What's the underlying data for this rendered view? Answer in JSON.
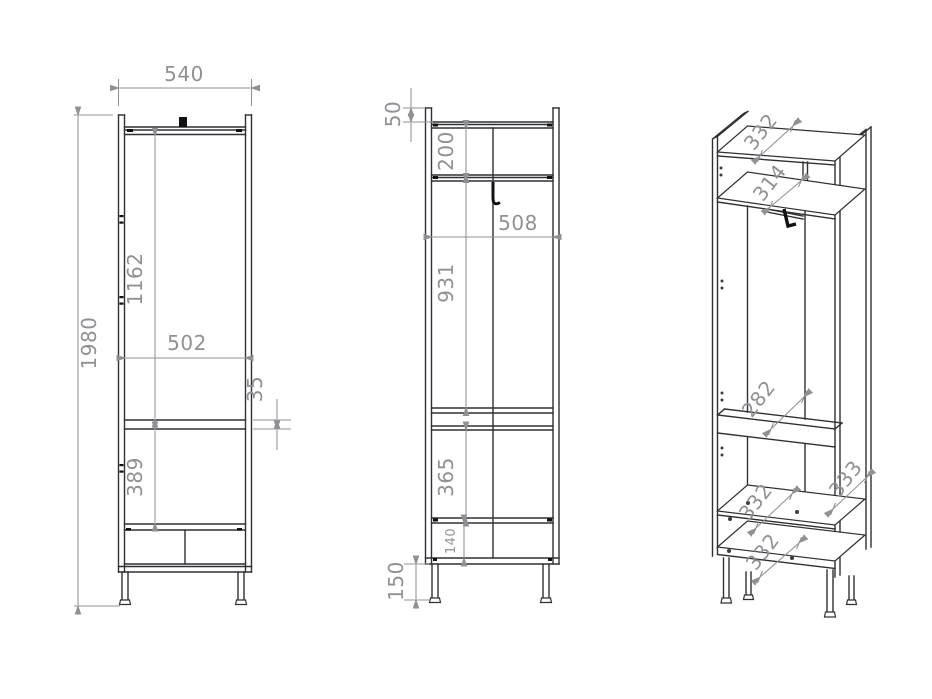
{
  "document": {
    "type": "furniture-technical-drawing",
    "subject": "tall wardrobe cabinet, three views"
  },
  "colors": {
    "background": "#ffffff",
    "line": "#2e3033",
    "dimension": "#8f9194",
    "detail": "#111111"
  },
  "views": {
    "front": {
      "label": "front-view",
      "dims": {
        "width": "540",
        "height": "1980",
        "upper_interior_height": "1162",
        "interior_width": "502",
        "shelf_gap": "35",
        "lower_interior_height": "389"
      }
    },
    "side": {
      "label": "side-view",
      "dims": {
        "top_lip": "50",
        "top_compartment": "200",
        "interior_depth": "508",
        "hanging_height": "931",
        "lower_compartment": "365",
        "drawer_height": "140",
        "leg_height": "150"
      }
    },
    "perspective": {
      "label": "perspective-view",
      "dims": {
        "top_panel_depth": "332",
        "shelf_depth": "314",
        "rail_offset": "282",
        "side_panel_depth": "333",
        "bottom_shelf_depth": "332",
        "bottom_panel_depth": "332"
      }
    }
  }
}
